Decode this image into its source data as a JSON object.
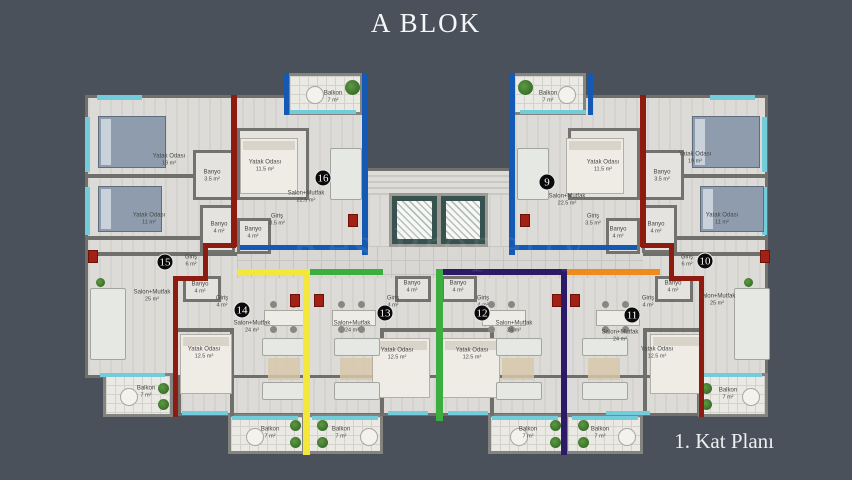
{
  "title": "A BLOK",
  "caption": "1. Kat Planı",
  "watermark": "RestProperty",
  "background_color": "#4a515b",
  "plan": {
    "units": [
      {
        "number": "9",
        "color": "#1459b3",
        "badge": {
          "x": 547,
          "y": 182
        }
      },
      {
        "number": "10",
        "color": "#8e1b10",
        "badge": {
          "x": 705,
          "y": 261
        }
      },
      {
        "number": "11",
        "color": "#ef8b1d",
        "badge": {
          "x": 632,
          "y": 315
        }
      },
      {
        "number": "12",
        "color": "#2c1a66",
        "badge": {
          "x": 482,
          "y": 313
        }
      },
      {
        "number": "13",
        "color": "#3cae3f",
        "badge": {
          "x": 385,
          "y": 313
        }
      },
      {
        "number": "14",
        "color": "#f2e73a",
        "badge": {
          "x": 242,
          "y": 310
        }
      },
      {
        "number": "15",
        "color": "#8e1b10",
        "badge": {
          "x": 165,
          "y": 262
        }
      },
      {
        "number": "16",
        "color": "#1459b3",
        "badge": {
          "x": 323,
          "y": 178
        }
      }
    ],
    "rooms": [
      {
        "unit": "15",
        "label": "Yatak Odası",
        "area": "19 m²",
        "x": 169,
        "y": 160
      },
      {
        "unit": "15",
        "label": "Yatak Odası",
        "area": "11 m²",
        "x": 149,
        "y": 219
      },
      {
        "unit": "15",
        "label": "Banyo",
        "area": "3.5 m²",
        "x": 212,
        "y": 176
      },
      {
        "unit": "15",
        "label": "Banyo",
        "area": "4 m²",
        "x": 219,
        "y": 228
      },
      {
        "unit": "15",
        "label": "Giriş",
        "area": "6 m²",
        "x": 191,
        "y": 261
      },
      {
        "unit": "15",
        "label": "Salon+Mutfak",
        "area": "25 m²",
        "x": 152,
        "y": 296
      },
      {
        "unit": "15",
        "label": "Balkon",
        "area": "7 m²",
        "x": 146,
        "y": 392
      },
      {
        "unit": "16",
        "label": "Balkon",
        "area": "7 m²",
        "x": 333,
        "y": 97
      },
      {
        "unit": "16",
        "label": "Yatak Odası",
        "area": "11.5 m²",
        "x": 265,
        "y": 166
      },
      {
        "unit": "16",
        "label": "Salon+Mutfak",
        "area": "22.5 m²",
        "x": 306,
        "y": 197
      },
      {
        "unit": "16",
        "label": "Giriş",
        "area": "3.5 m²",
        "x": 277,
        "y": 220
      },
      {
        "unit": "16",
        "label": "Banyo",
        "area": "4 m²",
        "x": 253,
        "y": 233
      },
      {
        "unit": "9",
        "label": "Balkon",
        "area": "7 m²",
        "x": 548,
        "y": 97
      },
      {
        "unit": "9",
        "label": "Yatak Odası",
        "area": "11.5 m²",
        "x": 603,
        "y": 166
      },
      {
        "unit": "9",
        "label": "Salon+Mutfak",
        "area": "22.5 m²",
        "x": 567,
        "y": 200
      },
      {
        "unit": "9",
        "label": "Giriş",
        "area": "3.5 m²",
        "x": 593,
        "y": 220
      },
      {
        "unit": "9",
        "label": "Banyo",
        "area": "4 m²",
        "x": 618,
        "y": 233
      },
      {
        "unit": "10",
        "label": "Yatak Odası",
        "area": "19 m²",
        "x": 695,
        "y": 158
      },
      {
        "unit": "10",
        "label": "Yatak Odası",
        "area": "11 m²",
        "x": 722,
        "y": 219
      },
      {
        "unit": "10",
        "label": "Banyo",
        "area": "3.5 m²",
        "x": 662,
        "y": 176
      },
      {
        "unit": "10",
        "label": "Banyo",
        "area": "4 m²",
        "x": 656,
        "y": 228
      },
      {
        "unit": "10",
        "label": "Giriş",
        "area": "6 m²",
        "x": 687,
        "y": 261
      },
      {
        "unit": "10",
        "label": "Salon+Mutfak",
        "area": "25 m²",
        "x": 717,
        "y": 300
      },
      {
        "unit": "10",
        "label": "Balkon",
        "area": "7 m²",
        "x": 728,
        "y": 394
      },
      {
        "unit": "14",
        "label": "Banyo",
        "area": "4 m²",
        "x": 200,
        "y": 288
      },
      {
        "unit": "14",
        "label": "Giriş",
        "area": "4 m²",
        "x": 222,
        "y": 302
      },
      {
        "unit": "14",
        "label": "Salon+Mutfak",
        "area": "24 m²",
        "x": 252,
        "y": 327
      },
      {
        "unit": "14",
        "label": "Yatak Odası",
        "area": "12.5 m²",
        "x": 204,
        "y": 353
      },
      {
        "unit": "14",
        "label": "Balkon",
        "area": "7 m²",
        "x": 270,
        "y": 433
      },
      {
        "unit": "13",
        "label": "Banyo",
        "area": "4 m²",
        "x": 412,
        "y": 287
      },
      {
        "unit": "13",
        "label": "Giriş",
        "area": "4 m²",
        "x": 393,
        "y": 302
      },
      {
        "unit": "13",
        "label": "Salon+Mutfak",
        "area": "24 m²",
        "x": 352,
        "y": 327
      },
      {
        "unit": "13",
        "label": "Yatak Odası",
        "area": "12.5 m²",
        "x": 397,
        "y": 354
      },
      {
        "unit": "13",
        "label": "Balkon",
        "area": "7 m²",
        "x": 341,
        "y": 433
      },
      {
        "unit": "12",
        "label": "Banyo",
        "area": "4 m²",
        "x": 458,
        "y": 287
      },
      {
        "unit": "12",
        "label": "Giriş",
        "area": "4 m²",
        "x": 483,
        "y": 302
      },
      {
        "unit": "12",
        "label": "Salon+Mutfak",
        "area": "24 m²",
        "x": 514,
        "y": 327
      },
      {
        "unit": "12",
        "label": "Yatak Odası",
        "area": "12.5 m²",
        "x": 472,
        "y": 354
      },
      {
        "unit": "12",
        "label": "Balkon",
        "area": "7 m²",
        "x": 528,
        "y": 433
      },
      {
        "unit": "11",
        "label": "Banyo",
        "area": "4 m²",
        "x": 673,
        "y": 287
      },
      {
        "unit": "11",
        "label": "Giriş",
        "area": "4 m²",
        "x": 648,
        "y": 302
      },
      {
        "unit": "11",
        "label": "Salon+Mutfak",
        "area": "24 m²",
        "x": 620,
        "y": 336
      },
      {
        "unit": "11",
        "label": "Yatak Odası",
        "area": "12.5 m²",
        "x": 657,
        "y": 353
      },
      {
        "unit": "11",
        "label": "Balkon",
        "area": "7 m²",
        "x": 600,
        "y": 433
      }
    ]
  }
}
